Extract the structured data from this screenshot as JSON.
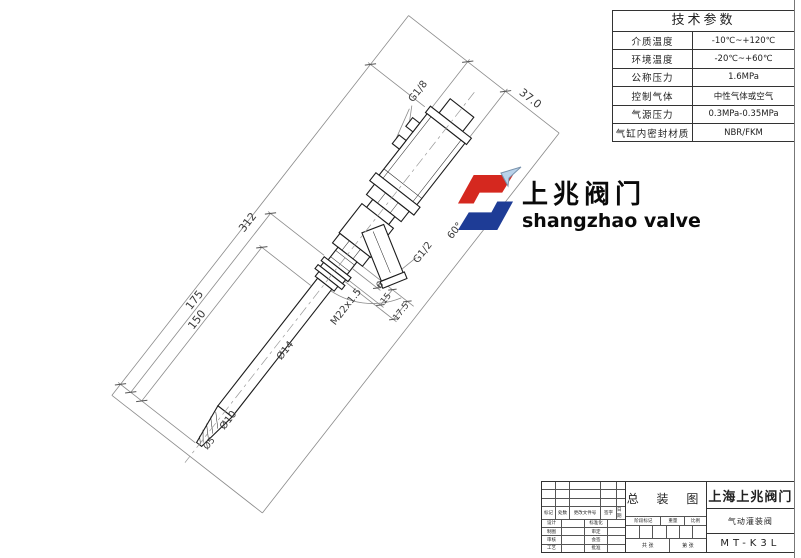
{
  "params_table": {
    "title": "技术参数",
    "rows": [
      {
        "label": "介质温度",
        "value": "-10℃~+120℃"
      },
      {
        "label": "环境温度",
        "value": "-20℃~+60℃"
      },
      {
        "label": "公称压力",
        "value": "1.6MPa"
      },
      {
        "label": "控制气体",
        "value": "中性气体或空气"
      },
      {
        "label": "气源压力",
        "value": "0.3MPa-0.35MPa"
      },
      {
        "label": "气缸内密封材质",
        "value": "NBR/FKM"
      }
    ]
  },
  "logo": {
    "cn": "上兆阀门",
    "en": "shangzhao valve",
    "red": "#d5281f",
    "blue": "#1e3c96"
  },
  "dims": {
    "d312": "312",
    "d175": "175",
    "d150": "150",
    "d370": "37.0",
    "g18": "G1/8",
    "g12": "G1/2",
    "m22": "M22x1.5",
    "d6": "6",
    "d15": "15",
    "d17_5": "17.5",
    "dia14": "Ø14",
    "dia10": "Ø10",
    "dia5": "Ø5",
    "a60": "60°"
  },
  "title_block": {
    "company": "上海上兆阀门",
    "product": "气动灌装阀",
    "model": "MT-K3L",
    "doc_type": "总 装 图",
    "rev_header": [
      "标记",
      "处数",
      "更改文件号",
      "签字",
      "日期"
    ],
    "sign_left": [
      "设计",
      "制图",
      "审核",
      "工艺"
    ],
    "sign_right": [
      "标准化",
      "审定",
      "会签",
      "批准"
    ],
    "stage": [
      "阶段标记",
      "重量",
      "比例"
    ],
    "sheet_left": "共 张",
    "sheet_right": "第 张"
  }
}
